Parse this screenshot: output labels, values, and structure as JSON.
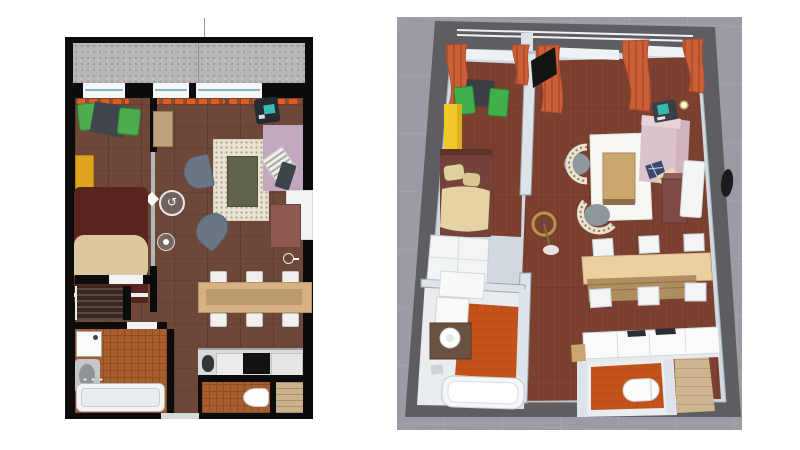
{
  "meta": {
    "description": "Apartment floor plan, 2D top view and 3D aerial view side by side"
  },
  "palette2d": {
    "wall": "#0c0c0c",
    "balcony": "#b6b6b6",
    "balcony_dot": "#9c9c9c",
    "window": "#f4f6f8",
    "window_line": "#8cb0c8",
    "wood": "#6d4738",
    "curtain": "#e65a1c",
    "chair_green": "#4bad4d",
    "chair_green_dark": "#2f8c38",
    "table_dark": "#41464e",
    "wardrobe_yellow": "#dea41d",
    "bed_red": "#58241e",
    "blanket": "#dcc89d",
    "slat": "#362820",
    "slat_line": "#5a493c",
    "rug": "#e9e3d2",
    "rug_table": "#61634a",
    "armchair": "#6b7684",
    "desk": "#262a32",
    "screen": "#3bbcb2",
    "sofa_pink": "#c2a8bf",
    "cushion": "#f0efe8",
    "remote": "#3d434b",
    "dresser": "#8d5951",
    "console": "#f3f3f3",
    "dining": "#d5b184",
    "dining_inner": "#bd9a6d",
    "chair_white": "#efefef",
    "counter": "#d8dadb",
    "cooktop": "#121212",
    "sink_dark": "#303538",
    "tile": "#a85d2f",
    "tile_line": "#8f4d20",
    "entry_wood": "#c9b28c",
    "door_white": "#f3f3f3",
    "track": "#b4b7b9",
    "overlay_ring": "#e9e9e9",
    "overlay_fill": "rgba(120,120,120,0.55)"
  },
  "palette3d": {
    "bg": "#9b9ba3",
    "grid": "#a9a9b1",
    "wall_dark": "#5e5e62",
    "wall_light": "#cfd9df",
    "wall_partition": "#dde4e9",
    "rail_line": "#eef2f4",
    "room_white": "#e9edf0",
    "wood": "#7b4030",
    "wood_seam": "#68342a",
    "tile": "#c2531a",
    "tile_line": "#ad4410",
    "entry_wood": "#cdb590",
    "curtain": "#cd5f38",
    "curtain_dark": "#b34e2b",
    "tv": "#141414",
    "chair_green": "#3fb04a",
    "table_dark": "#3a3f45",
    "cabinet_yellow": "#f0c82a",
    "cabinet_yellow_side": "#d8b01c",
    "bed_red": "#74423a",
    "bed_head": "#5f332c",
    "blanket": "#e5d3a6",
    "wardrobe_white": "#f2f4f5",
    "lamp_gold": "#b09a4a",
    "armchair_back": "#eae2cd",
    "armchair_seat": "#8e979e",
    "rug": "#f6f6f3",
    "coffee_table": "#c9a76e",
    "sofa_pink": "#dcc3cb",
    "sofa_pink_dark": "#cfb3bd",
    "pillow_navy": "#3a4a6b",
    "pillow_stripe": "#e8dcb8",
    "dresser": "#7e4a44",
    "dresser_top": "#96605a",
    "console": "#f4f6f6",
    "mirror": "#1c1c1c",
    "dining_top": "#ecd0a2",
    "dining_wood": "#b08d5e",
    "chair_white": "#f2f4f5",
    "counter": "#fafbfb",
    "cooktop": "#2b2f33",
    "bath_white": "#f4f7f8",
    "vanity": "#6b5140",
    "toilet": "#fbfdfd"
  },
  "plan2d": {
    "label": "2D floor plan (top view)",
    "overlays": [
      {
        "name": "sliding-door-handle",
        "glyph": "diamond"
      },
      {
        "name": "rotate-control",
        "glyph": "↺"
      },
      {
        "name": "camera-marker",
        "glyph": "dot"
      },
      {
        "name": "furniture-indicator",
        "count": 2
      }
    ],
    "rooms": [
      {
        "name": "balcony",
        "items": [
          "railing",
          "divider line"
        ]
      },
      {
        "name": "bedroom",
        "items": [
          "green chair x2",
          "dark side table",
          "yellow wardrobe",
          "double bed with beige throw",
          "slatted shelf"
        ]
      },
      {
        "name": "living-room",
        "items": [
          "tall cabinet",
          "cream rug",
          "olive coffee table",
          "gray armchair x2",
          "computer desk",
          "pink sofa",
          "striped cushion",
          "dark tablet",
          "white console",
          "red-brown dresser",
          "dining table",
          "white chair x6"
        ]
      },
      {
        "name": "kitchen",
        "items": [
          "counter",
          "sink",
          "cooktop"
        ]
      },
      {
        "name": "bathroom",
        "items": [
          "washing machine",
          "washbasin",
          "bathtub"
        ]
      },
      {
        "name": "wc",
        "items": [
          "toilet"
        ]
      },
      {
        "name": "entry",
        "items": [
          "wood floor"
        ]
      }
    ]
  },
  "view3d": {
    "label": "3D aerial view",
    "rooms": [
      {
        "name": "balcony",
        "items": [
          "glass railing"
        ]
      },
      {
        "name": "bedroom",
        "items": [
          "orange curtains",
          "green chair x2",
          "dark table",
          "yellow cabinet",
          "bed with beige throw",
          "white wardrobe"
        ]
      },
      {
        "name": "living-room",
        "items": [
          "orange curtains x4",
          "wall tv",
          "tall wood cabinet",
          "computer desk",
          "gold floor lamp",
          "white rug",
          "wood coffee table",
          "patterned armchair x2",
          "pink sofa with pillows",
          "dresser",
          "white console",
          "wall mirror",
          "dining table",
          "white chair x6"
        ]
      },
      {
        "name": "kitchen",
        "items": [
          "white counters",
          "cooktop"
        ]
      },
      {
        "name": "bathroom",
        "items": [
          "washing machine",
          "counter",
          "vanity with basin",
          "bathtub"
        ]
      },
      {
        "name": "wc",
        "items": [
          "toilet"
        ]
      },
      {
        "name": "entry",
        "items": [
          "light wood floor"
        ]
      }
    ]
  }
}
